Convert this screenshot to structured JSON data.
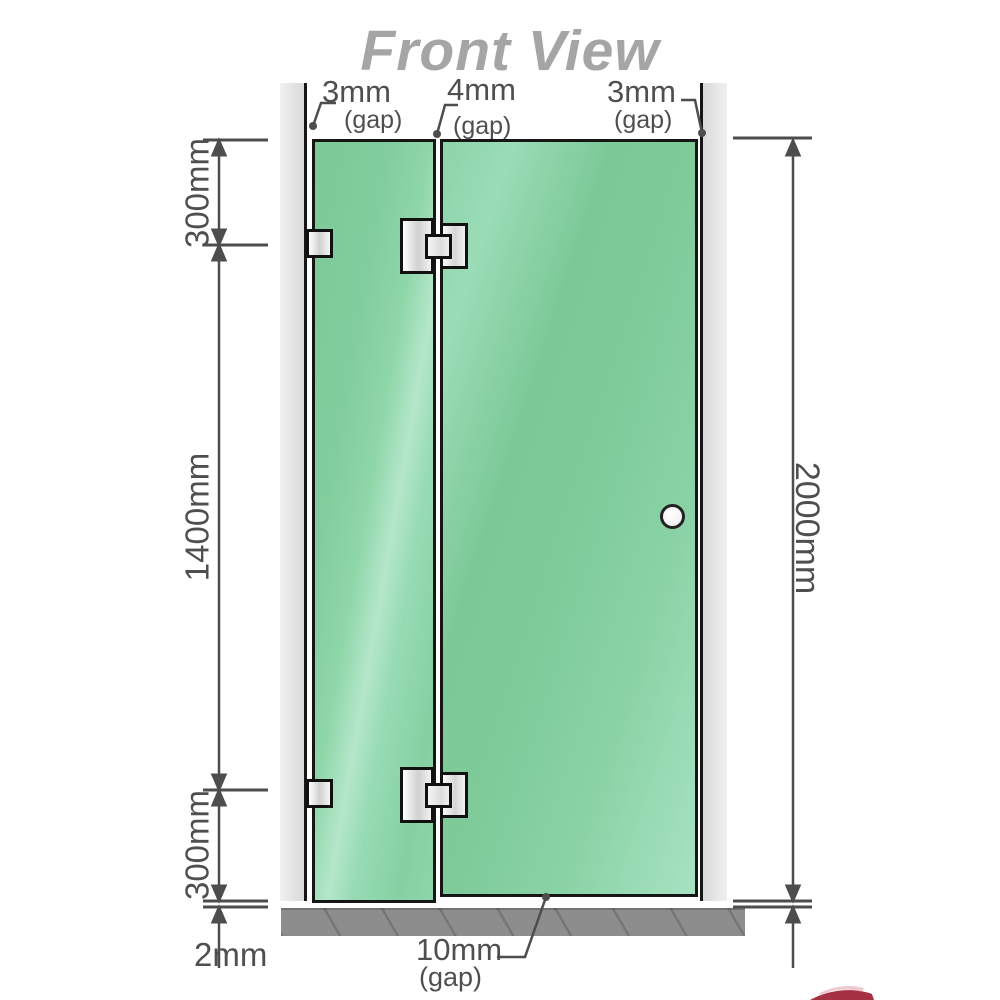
{
  "title": "Front View",
  "top_gaps": {
    "left": {
      "value": "3mm",
      "note": "(gap)"
    },
    "middle": {
      "value": "4mm",
      "note": "(gap)"
    },
    "right": {
      "value": "3mm",
      "note": "(gap)"
    }
  },
  "left_dimensions": {
    "top": "300mm",
    "middle": "1400mm",
    "bottom": "300mm",
    "floor_gap": "2mm"
  },
  "right_dimension": "2000mm",
  "bottom_gap": {
    "value": "10mm",
    "note": "(gap)"
  },
  "colors": {
    "glass_green": "#84cfa1",
    "glass_highlight": "#b4e7ca",
    "wall_gray": "#e4e4e4",
    "floor_gray": "#8d8d8d",
    "dimension_line": "#4d4d4d",
    "title_gray": "#a5a5a5",
    "watermark_red": "#9c1b2e"
  }
}
